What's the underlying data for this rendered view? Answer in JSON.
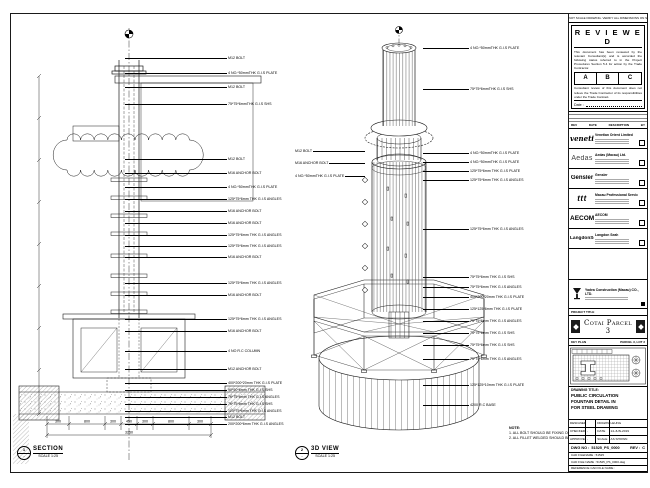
{
  "frame": {
    "top_note": "DO NOT SCALE DRAWING. VERIFY ALL DIMENSIONS ON SITE."
  },
  "stamp": {
    "title": "R E V I E W E D",
    "para1": "This document has been reviewed by the relevant Consultant(s) and is accorded the following status referred to in the Project Procedures Section 5.4 for action by the Trade Contractor.",
    "status_a": "A",
    "status_b": "B",
    "status_c": "C",
    "para2": "Consultant review of this document does not relieve the Trade Contractor of its responsibilities under the Trade Contract.",
    "date_label": "Date :"
  },
  "revisions": {
    "rev": "REV",
    "date": "DATE",
    "description": "DESCRIPTION",
    "by": "BY"
  },
  "consultants": [
    {
      "logo": "venetian",
      "cls": "c-venetian",
      "name": "Venetian Orient Limited"
    },
    {
      "logo": "Aedas",
      "cls": "c-aedas",
      "name": "Aedas (Macau) Ltd."
    },
    {
      "logo": "Gensler",
      "cls": "c-gensler",
      "name": "Gensler"
    },
    {
      "logo": "ttt",
      "cls": "c-ttt",
      "name": "Macau Professional Services Ltd."
    },
    {
      "logo": "AECOM",
      "cls": "c-aecom",
      "name": "AECOM"
    },
    {
      "logo": "LangdonSeah",
      "cls": "c-lseah",
      "name": "Langdon Seah"
    }
  ],
  "contractor": {
    "name": "Yadea Construction (Macau) CO., LTD."
  },
  "project": {
    "label": "PROJECT TITLE",
    "title": "Cotai Parcel 3"
  },
  "key_plan": {
    "label": "KEY PLAN",
    "zone": "PARCEL 3, LOT 2"
  },
  "title_block": {
    "drawing_title_label": "DRAWING TITLE:",
    "line1": "PUBLIC CIRCULATION",
    "line2": "FOUNTAIN DETAIL IN",
    "line3": "FOR STEEL DRAWING",
    "designed_label": "DESIGNED",
    "designed": "",
    "drawn_label": "DRAWN",
    "drawn": "LEUNG",
    "checked_label": "CHECKED",
    "checked": "-",
    "date_label": "DATE",
    "date": "14-JUN-2019",
    "approved_label": "APPROVED",
    "approved": "-",
    "scale_label": "SCALE",
    "scale": "AS SHOWN",
    "dwg_no_label": "DWG NO :",
    "dwg_no": "51525_PS_0000",
    "rev_label": "REV :",
    "rev": "C",
    "cad_rows": [
      "CAD FILENAME : 51525",
      "CAD FILE NAME : 51525_PS_0000.dwg",
      "REFERENCE CAD FILE NAME :"
    ]
  },
  "section_view": {
    "bubble_no": "1",
    "bubble_ref": "-",
    "name": "SECTION",
    "scale": "SCALE 1:25",
    "callouts": [
      {
        "y": 35,
        "t": "M12 BOLT"
      },
      {
        "y": 50,
        "t": "4 NO.*50mmTHK G.I.S PLATE"
      },
      {
        "y": 64,
        "t": "M12 BOLT"
      },
      {
        "y": 81,
        "t": "75*75*6mmTHK G.I.S SHS"
      },
      {
        "y": 136,
        "t": "M12 BOLT"
      },
      {
        "y": 150,
        "t": "M16 ANCHOR BOLT"
      },
      {
        "y": 164,
        "t": "4 NO.*50mmTHK G.I.S PLATE"
      },
      {
        "y": 176,
        "t": "125*75*6mm THK G.I.S ANGLES"
      },
      {
        "y": 188,
        "t": "M16 ANCHOR BOLT"
      },
      {
        "y": 200,
        "t": "M16 ANCHOR BOLT"
      },
      {
        "y": 212,
        "t": "125*75*6mm THK G.I.S ANGLES"
      },
      {
        "y": 223,
        "t": "125*75*6mm THK G.I.S ANGLES"
      },
      {
        "y": 234,
        "t": "M16 ANCHOR BOLT"
      },
      {
        "y": 260,
        "t": "125*75*6mm THK G.I.S ANGLES"
      },
      {
        "y": 272,
        "t": "M16 ANCHOR BOLT"
      },
      {
        "y": 296,
        "t": "125*75*6mm THK G.I.S ANGLES"
      },
      {
        "y": 308,
        "t": "M16 ANCHOR BOLT"
      },
      {
        "y": 328,
        "t": "4 NO R.C COLUMN"
      },
      {
        "y": 346,
        "t": "M12 ANCHOR BOLT"
      },
      {
        "y": 360,
        "t": "400*200*20mm THK G.I.S PLATE"
      },
      {
        "y": 367,
        "t": "90*50*6mm THK G.I.S SHS"
      },
      {
        "y": 374,
        "t": "75*75*6mm THK G.I.S ANGLES"
      },
      {
        "y": 381,
        "t": "75*75*6mm THK G.I.S SHS"
      },
      {
        "y": 388,
        "t": "125*75*6mm THK G.I.S ANGLES"
      },
      {
        "y": 394,
        "t": "M12 BOLT"
      },
      {
        "y": 401,
        "t": "200*200*6mm THK G.I.S ANGLES"
      }
    ],
    "dims": {
      "segments": [
        "300",
        "800",
        "300",
        "450",
        "300",
        "800",
        "300"
      ],
      "total": "3250"
    }
  },
  "iso_view": {
    "bubble_no": "2",
    "bubble_ref": "-",
    "name": "3D VIEW",
    "scale": "SCALE 1:25",
    "callouts_right": [
      {
        "y": 25,
        "t": "4 NO.*50mmTHK G.I.S PLATE"
      },
      {
        "y": 66,
        "t": "75*75*6mmTHK G.I.S SHS"
      },
      {
        "y": 130,
        "t": "4 NO.*50mmTHK G.I.S PLATE"
      },
      {
        "y": 139,
        "t": "4 NO.*50mmTHK G.I.S PLATE"
      },
      {
        "y": 148,
        "t": "125*75*6mm THK G.I.S PLATE"
      },
      {
        "y": 157,
        "t": "125*75*6mm THK G.I.S ANGLES"
      },
      {
        "y": 206,
        "t": "125*75*6mm THK G.I.S ANGLES"
      },
      {
        "y": 254,
        "t": "75*75*6mm THK G.I.S SHS"
      },
      {
        "y": 264,
        "t": "75*75*6mm THK G.I.S ANGLES"
      },
      {
        "y": 274,
        "t": "400*200*20mm THK G.I.S PLATE"
      },
      {
        "y": 286,
        "t": "125*125*6mm THK G.I.S PLATE"
      },
      {
        "y": 298,
        "t": "75*75*6mm THK G.I.S ANGLES"
      },
      {
        "y": 310,
        "t": "75*75*6mm THK G.I.S SHS"
      },
      {
        "y": 322,
        "t": "75*75*6mm THK G.I.S SHS"
      },
      {
        "y": 336,
        "t": "75*75*6mm THK G.I.S ANGLES"
      },
      {
        "y": 362,
        "t": "125*125*10mm THK G.I.S PLATE"
      },
      {
        "y": 382,
        "t": "4200 R.C BASE"
      }
    ],
    "callouts_left": [
      {
        "y": 128,
        "t": "M12 BOLT"
      },
      {
        "y": 140,
        "t": "M16 ANCHOR BOLT"
      },
      {
        "y": 153,
        "t": "4 NO.*50mmTHK G.I.S PLATE"
      }
    ]
  },
  "note": {
    "title": "NOTE:",
    "lines": [
      "1. ALL BOLT SHOULD BE FIXING ON SITE.",
      "2. ALL FILLET WELDED SHOULD BE 6mm THK."
    ]
  }
}
